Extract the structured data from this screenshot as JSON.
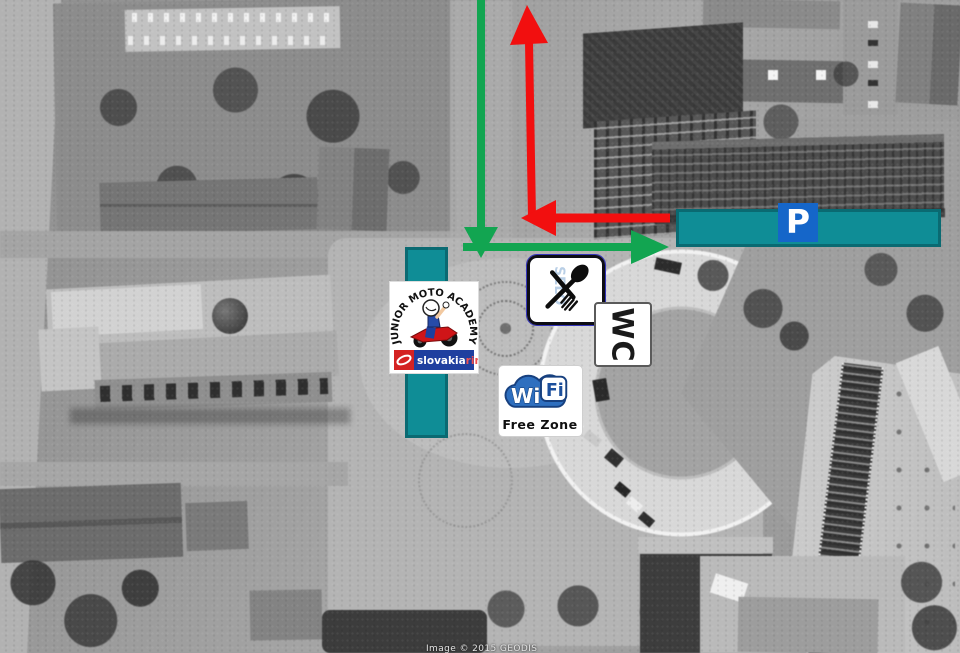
{
  "signs": {
    "parking": {
      "label": "P",
      "bar_color": "#0F8D96",
      "square_color": "#1566C9"
    },
    "junior_moto_academy": {
      "arc_text": "JUNIOR MOTO ACADEMY",
      "brand": "slovakia",
      "brand_suffix": "ring"
    },
    "restaurant": {
      "icon": "fork-and-spoon-crossed-icon",
      "watermark": "SELO"
    },
    "wc": {
      "label": "WC"
    },
    "wifi": {
      "wi": "Wi",
      "fi": "Fi",
      "subtitle": "Free Zone"
    }
  },
  "routes": {
    "green_arrow": {
      "color": "#12A551",
      "shape": "down-from-top-then-right"
    },
    "red_arrow": {
      "color": "#F20F0F",
      "shape": "left-then-up"
    }
  },
  "attribution": "Image © 2015 GEODIS"
}
